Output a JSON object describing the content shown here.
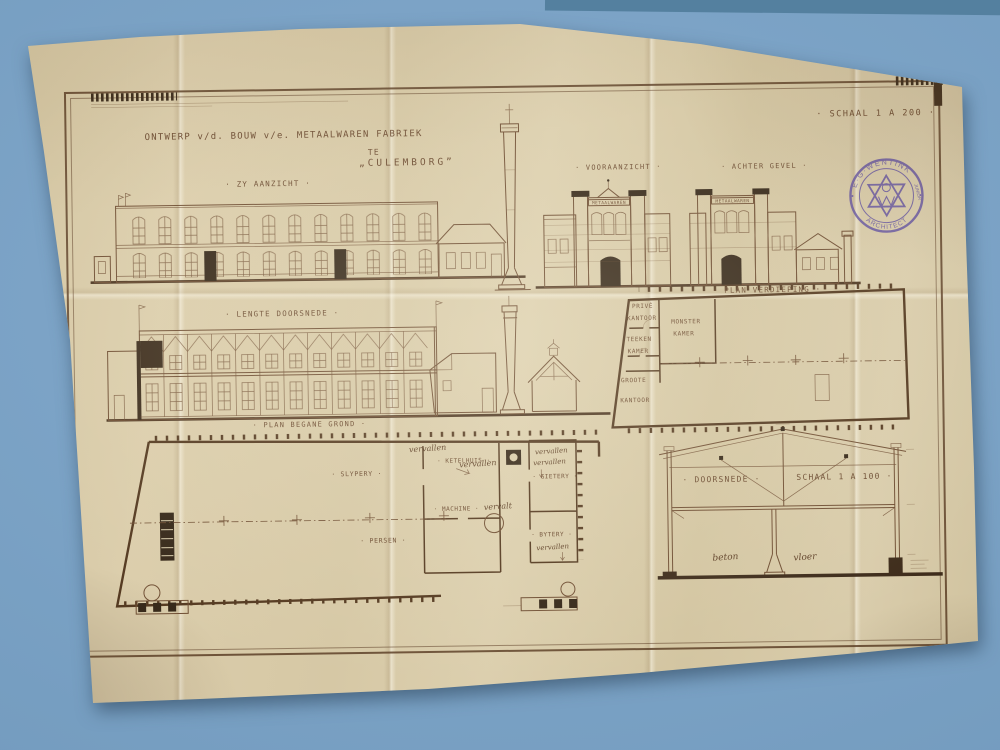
{
  "palette": {
    "backdrop_blue": "#7ba4c7",
    "table_edge_blue": "#54809f",
    "paper_cream": "#d8caa7",
    "ink_sepia": "#6f4e33",
    "ink_dark": "#342617",
    "stamp_purple": "#5b4aa0"
  },
  "title": {
    "line1": "ONTWERP v/d. BOUW v/e. METAALWAREN FABRIEK",
    "line2": "TE",
    "line3": "„CULEMBORG”"
  },
  "labels": {
    "schaal_200": "· SCHAAL 1 A 200 ·",
    "zy_aanzicht": "· ZY AANZICHT ·",
    "vooraanzicht": "· VOORAANZICHT ·",
    "achter_gevel": "· ACHTER GEVEL ·",
    "lengte_doorsnede": "· LENGTE DOORSNEDE ·",
    "plan_verdieping": "· PLAN VERDIEPING ·",
    "plan_begane_grond": "· PLAN BEGANE GROND ·",
    "doorsnede": "· DOORSNEDE ·",
    "schaal_100": "SCHAAL 1 A 100 ·"
  },
  "facade_sign": "METAALWAREN",
  "rooms_upper": {
    "prive_1": "PRIVÉ",
    "prive_2": "KANTOOR",
    "monster_1": "MONSTER",
    "monster_2": "KAMER",
    "teeken_1": "TEEKEN",
    "teeken_2": "KAMER",
    "groote_1": "GROOTE",
    "groote_2": "KANTOOR"
  },
  "rooms_ground": {
    "slypery": "· SLYPERY ·",
    "ketelhuis": "· KETELHUIS ·",
    "machine": "· MACHINE ·",
    "persen": "· PERSEN ·",
    "gietery": "· GIETERY ·",
    "bytery": "· BYTERY ·"
  },
  "handwritten": {
    "vervallen": "vervallen",
    "vervalt": "vervalt",
    "beton": "beton",
    "vloer": "vloer"
  },
  "stamp": {
    "name": "E·G·WENTINK",
    "junior": "JUNIOR",
    "title": "ARCHITECT"
  }
}
